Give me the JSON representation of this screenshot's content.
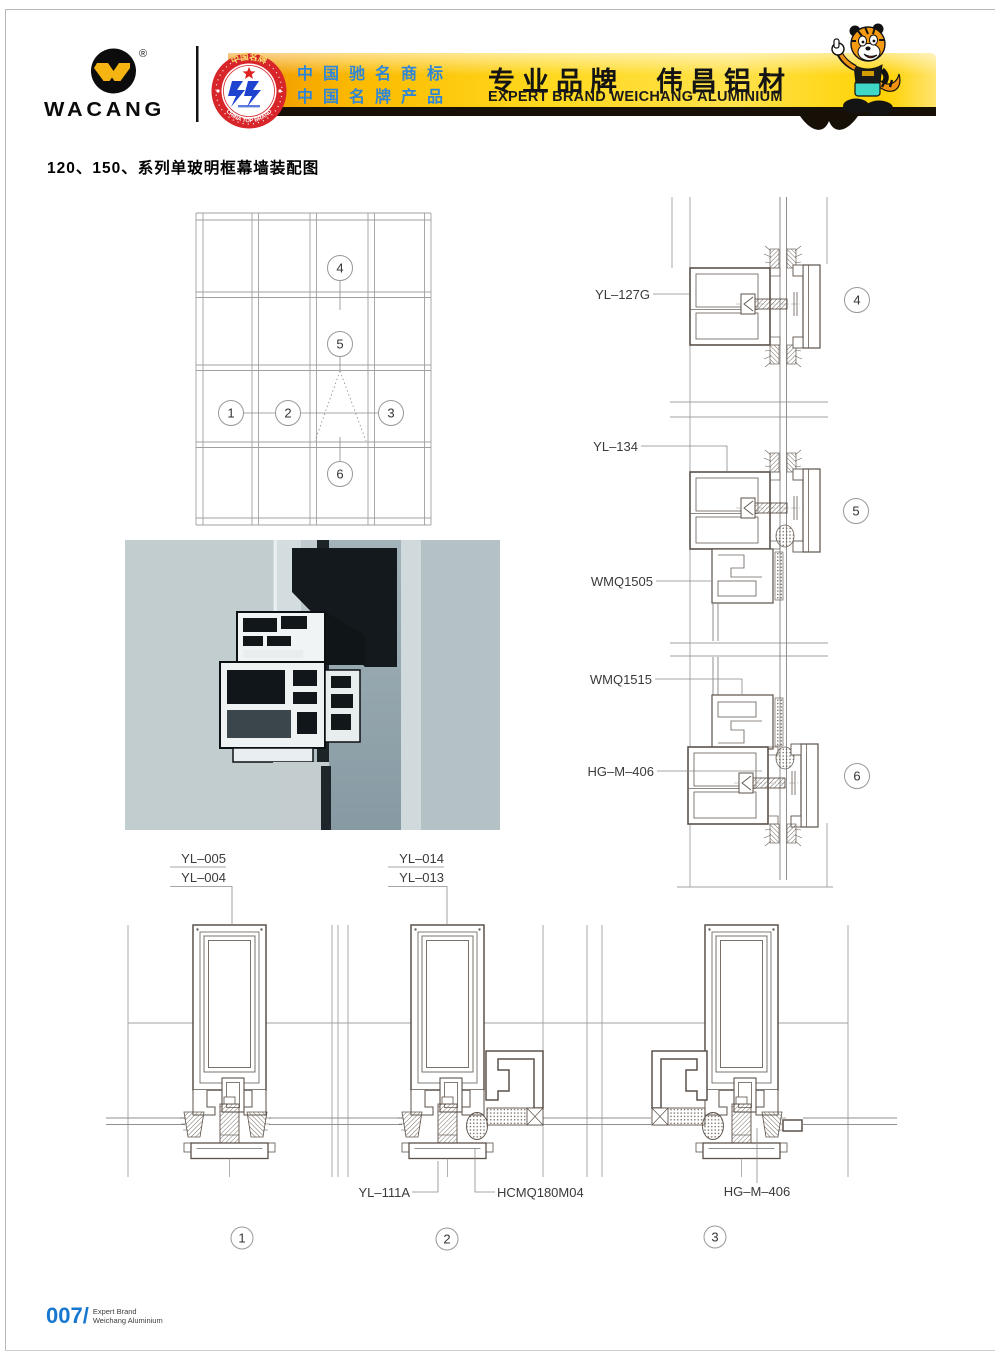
{
  "header": {
    "logo": {
      "name": "WACANG",
      "registered": "®"
    },
    "badge": {
      "arc_top": "中国名牌",
      "arc_bottom": "CHINA TOP BRAND"
    },
    "honor_line1": "中国驰名商标",
    "honor_line2": "中国名牌产品",
    "brand_cn_left": "专业品牌",
    "brand_cn_right": "伟昌铝材",
    "brand_en": "EXPERT BRAND WEICHANG ALUMINIUM",
    "colors": {
      "ribbon_yellow": "#ffd91e",
      "ribbon_orange": "#ef9000",
      "honor_blue": "#2f86d8",
      "badge_red": "#d7252a",
      "logo_yellow": "#f5b411"
    }
  },
  "doc": {
    "title": "120、150、系列单玻明框幕墙装配图"
  },
  "elevation_markers": {
    "m1": "1",
    "m2": "2",
    "m3": "3",
    "m4": "4",
    "m5": "5",
    "m6": "6"
  },
  "right_details": {
    "label_yl127g": "YL–127G",
    "label_yl134": "YL–134",
    "label_wmq1505": "WMQ1505",
    "label_wmq1515": "WMQ1515",
    "label_hgm406": "HG–M–406",
    "marker4": "4",
    "marker5": "5",
    "marker6": "6"
  },
  "bottom_details": {
    "label_yl005": "YL–005",
    "label_yl004": "YL–004",
    "label_yl014": "YL–014",
    "label_yl013": "YL–013",
    "label_yl111a": "YL–111A",
    "label_hcmq180m04": "HCMQ180M04",
    "label_hgm406": "HG–M–406",
    "marker1": "1",
    "marker2": "2",
    "marker3": "3"
  },
  "footer": {
    "page_no": "007/",
    "brand_line1": "Expert Brand",
    "brand_line2": "Weichang Aluminium"
  }
}
